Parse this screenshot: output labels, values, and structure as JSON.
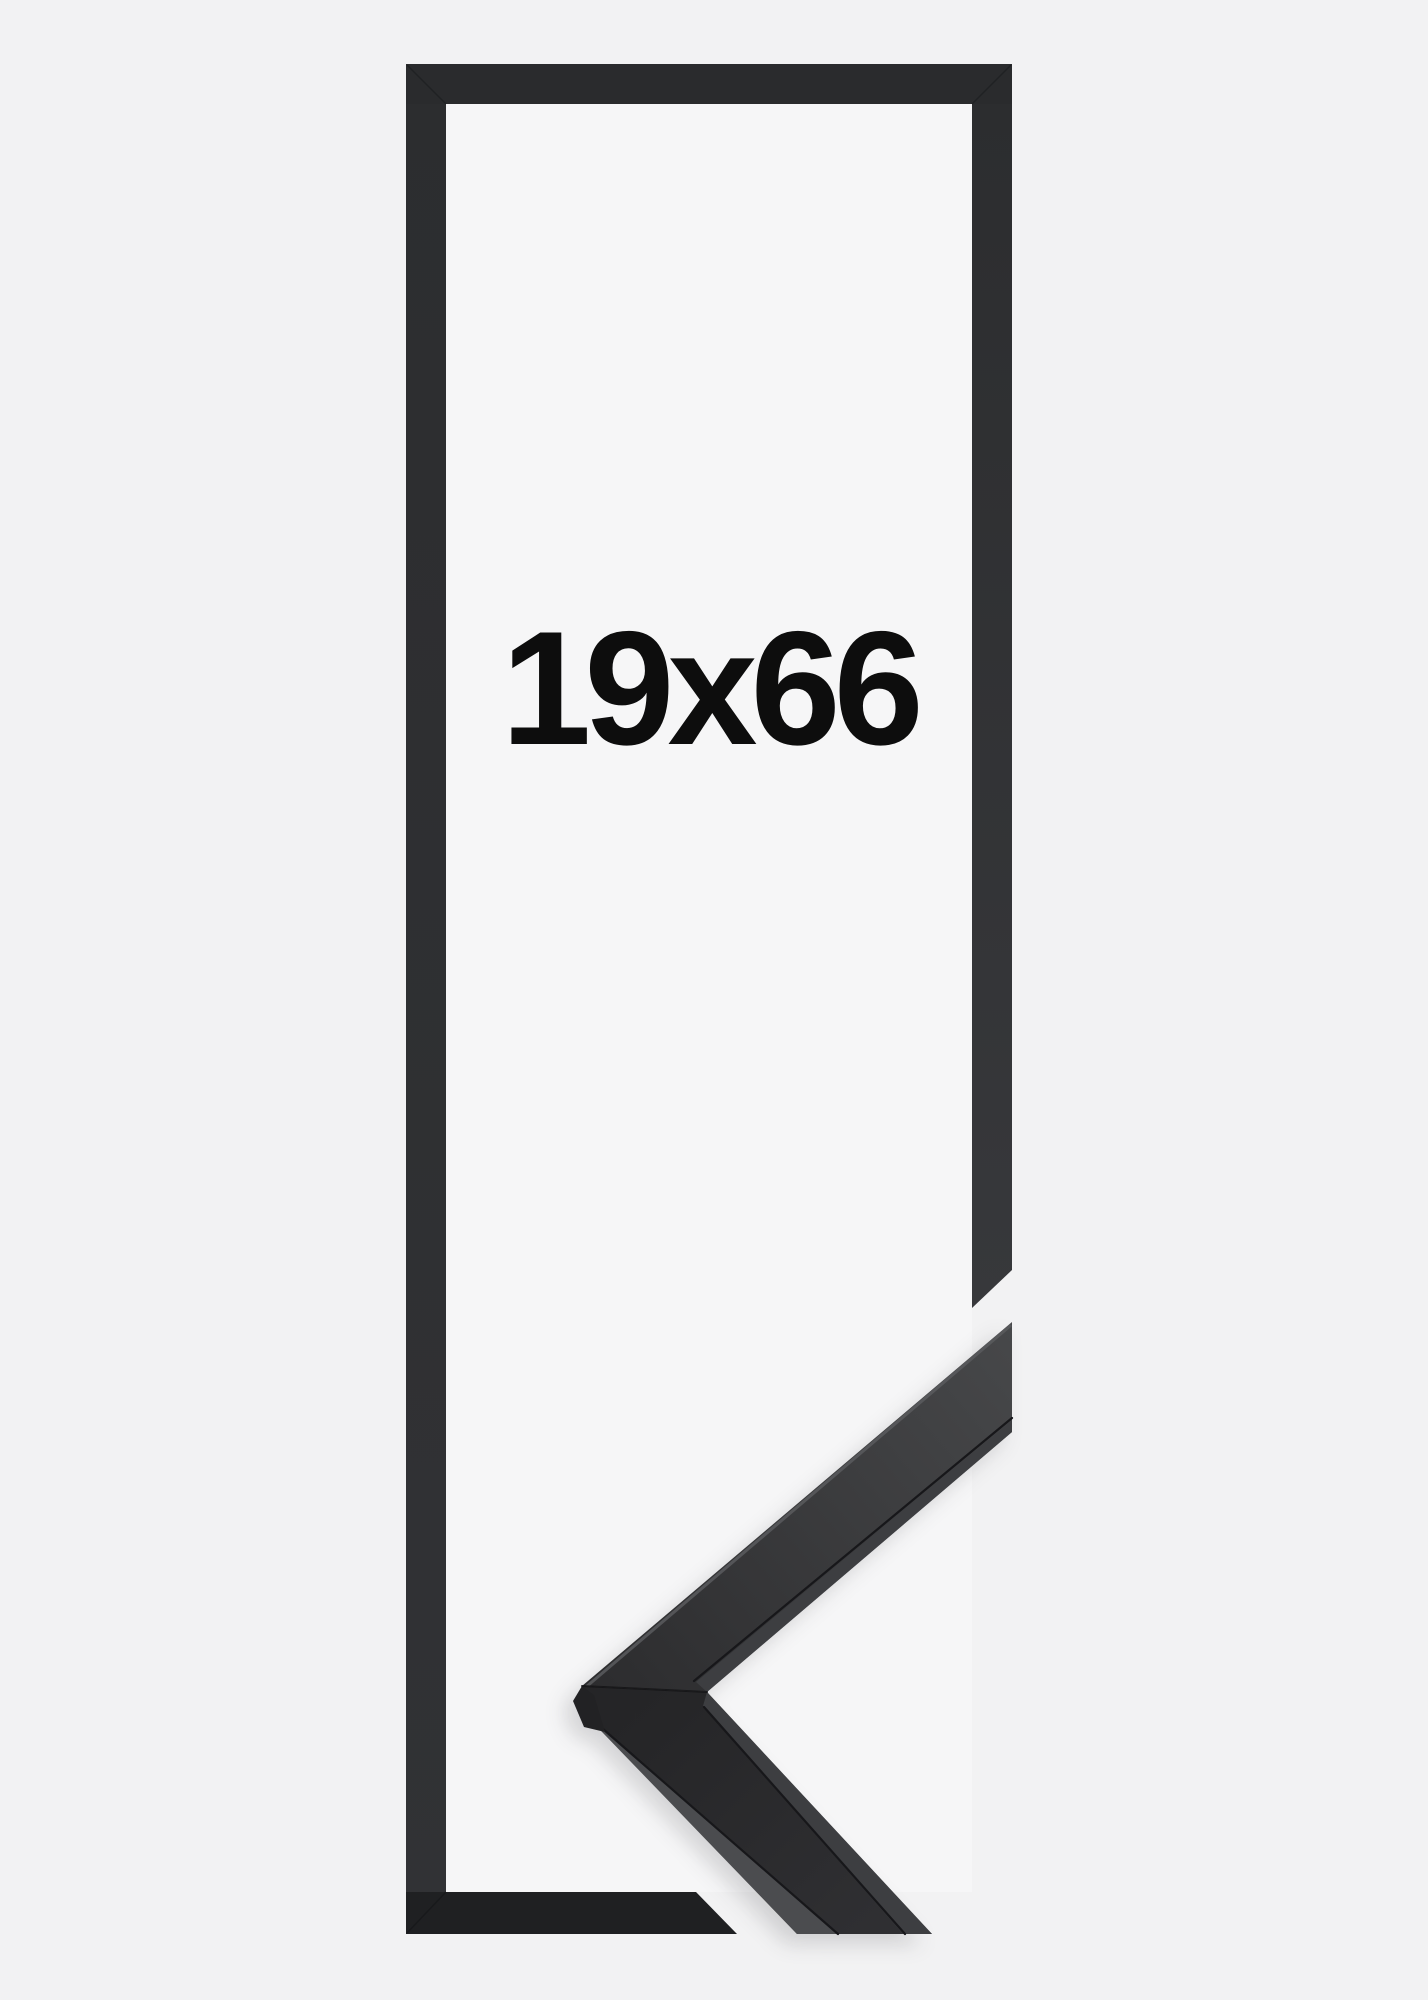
{
  "product": {
    "size_label": "19x66"
  },
  "colors": {
    "bg": "#f2f2f3",
    "interior": "#f6f6f7",
    "frame_top": "#2a2b2d",
    "frame_left_a": "#2c2d2f",
    "frame_left_b": "#313235",
    "frame_right_a": "#2c2d2f",
    "frame_right_b": "#37383b",
    "frame_bottom": "#1f2022",
    "sample_upper_a": "#2c2c2e",
    "sample_upper_b": "#47484a",
    "sample_lower_a": "#252527",
    "sample_lower_b": "#2f2f32",
    "side_face": "#4b4c4f",
    "lip_face": "#3d3e41",
    "crease": "#17171a",
    "edge_highlight": "#5a5b5e",
    "facet": "#222224",
    "seam": "#141416",
    "corner_seam": "rgba(10,10,12,0.3)",
    "label_text": "#0d0d0d"
  }
}
